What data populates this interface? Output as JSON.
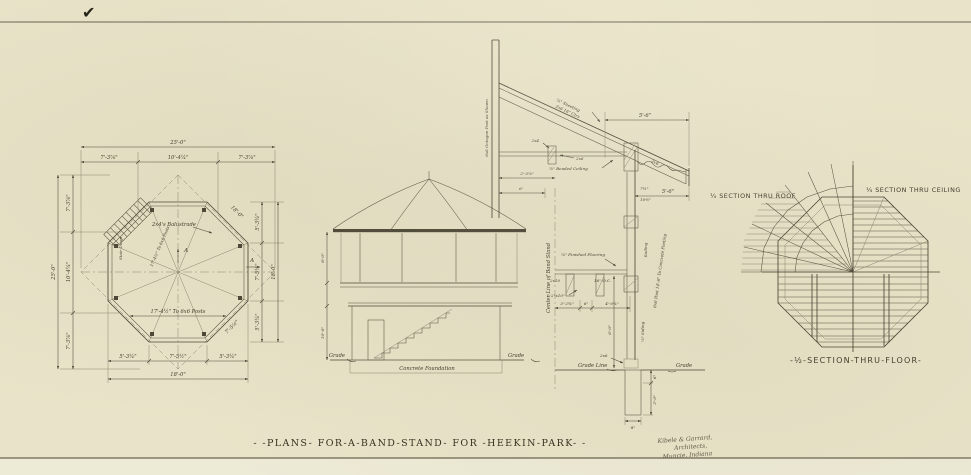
{
  "colors": {
    "paper": "#e9e4c9",
    "ink": "#4b4636",
    "faint": "#8a8470"
  },
  "page": {
    "checkmark": "✔"
  },
  "title_block": {
    "title": "- -PLANS- FOR-A-BAND-STAND- FOR -HEEKIN-PARK- -",
    "architect_line1": "Kibele & Garrard,",
    "architect_line2": "Architects,",
    "architect_line3": "Muncie, Indiana"
  },
  "floor_plan": {
    "dim_overall_top": "25'-0\"",
    "dim_top_left": "7'-3⅞\"",
    "dim_top_mid": "10'-4¼\"",
    "dim_top_right": "7'-3⅞\"",
    "dim_overall_left": "25'-0\"",
    "dim_left_top": "7'-3⅞\"",
    "dim_left_mid": "10'-4¼\"",
    "dim_left_bot": "7'-3⅞\"",
    "dim_right_top": "5'-3¼\"",
    "dim_right_mid": "7'-5½\"",
    "dim_right_bot": "5'-3¼\"",
    "dim_overall_right": "18'-0\"",
    "dim_bot_left": "5'-3¼\"",
    "dim_bot_mid": "7'-5½\"",
    "dim_bot_right": "5'-3¼\"",
    "dim_overall_bot": "18'-0\"",
    "dim_diag_ne": "18'-0\"",
    "dim_diag_se": "7'-5½\"",
    "label_balustrade": "2x4's Balustrade",
    "label_posts_radial": "17'-4½\" To 6x6 Posts",
    "label_posts_horiz": "17'-4½\" To 6x6 Posts",
    "label_stair": "Stair Down",
    "section_marker": "A"
  },
  "elevation": {
    "dim_upper": "8'-0\"",
    "dim_lower": "10'-0\"",
    "grade_left": "Grade",
    "grade_right": "Grade",
    "foundation": "Concrete Foundation"
  },
  "wall_section": {
    "post_label": "6x6 Octagon Post as Shown",
    "sheeting_line1": "⅞\" Sheeting",
    "sheeting_line2": "2x6 16\" Ctrs",
    "blocking": "2x4",
    "plate": "2x6",
    "beaded_ceiling": "⅞\" Beaded Ceiling",
    "tail": "2x6",
    "dim_ceiling_a": "2'-3⅞\"",
    "dim_ceiling_b": "6'",
    "dim_eave_top": "5'-6\"",
    "dim_eave_bot": "5'-6\"",
    "dim_rail_a": "7½\"",
    "dim_rail_b": "10½\"",
    "railing": "Railing",
    "finished_flooring": "⅞\" Finished Flooring",
    "joist": "2x10",
    "joist_spacing": "16\" O.C.",
    "double_joist": "2-2\"x10\"",
    "dim_floor_a": "3'-2¾\"",
    "dim_floor_b": "6\"",
    "dim_floor_c": "4'-0¾\"",
    "dim_height": "6'-0\"",
    "siding": "⅞\" Siding",
    "post_footing": "6x6 Post 14'-6\" To Concrete Footing",
    "sill": "2x6",
    "grade_line": "Grade Line",
    "grade": "Grade",
    "dim_footing_top": "6\"",
    "dim_footing_depth": "3'-0\"",
    "dim_footing_width": "8\"",
    "centerline": "Center Line of Band Stand"
  },
  "framing_plan": {
    "roof_label": "¼ Section Thru Roof",
    "ceiling_label": "¼ Section Thru Ceiling",
    "floor_caption": "-½-Section-Thru-Floor-"
  }
}
